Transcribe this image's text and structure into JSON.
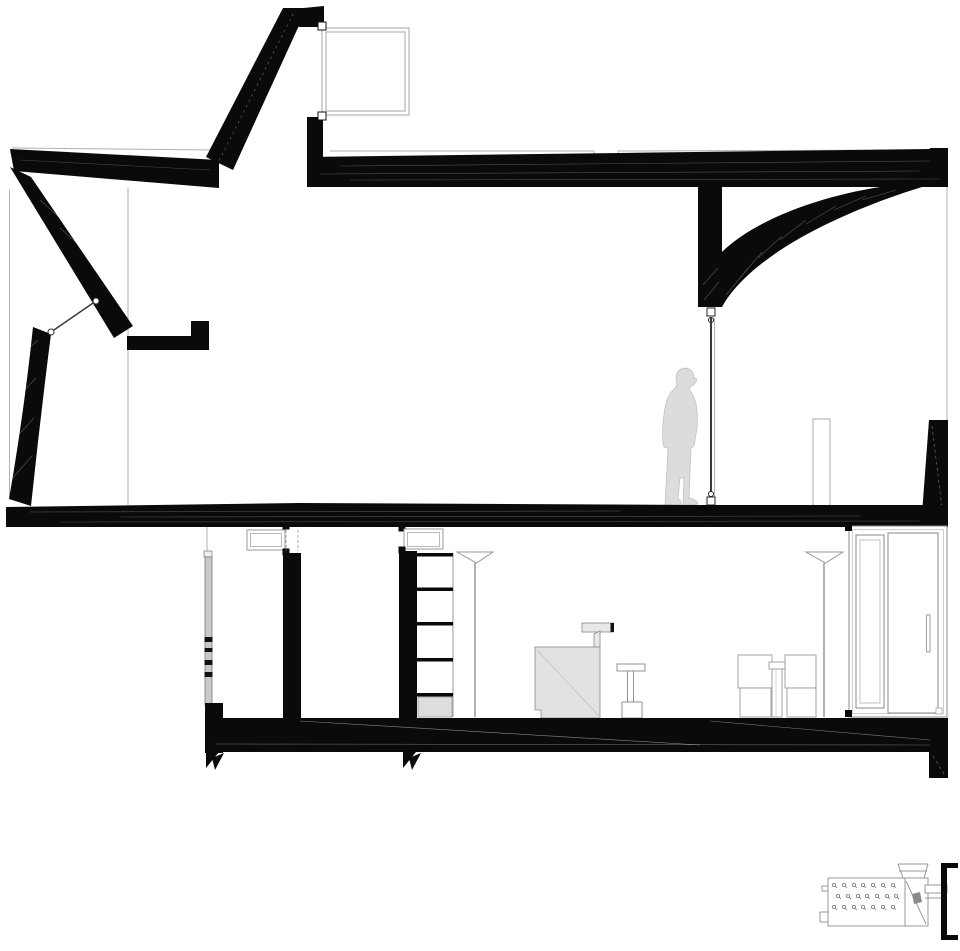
{
  "drawing": {
    "type": "architectural-longitudinal-section",
    "description": "Black-and-white architectural section drawing of a two-level interior with sloped roof, suspended column with curved haunch, tie rod, standing human figure, basement furniture and a small equipment detail at bottom right",
    "elements": [
      "chimney-cap",
      "skylight-window",
      "left-roof-slab",
      "right-roof-slab",
      "sloped-chimney-wall",
      "leaning-left-wall",
      "tie-cable",
      "ledge-bracket",
      "hanging-column",
      "curved-haunch",
      "tie-rod",
      "human-figure",
      "pilaster-outline",
      "right-wall-wedge",
      "main-floor-slab",
      "ceiling-cabinet-left",
      "ceiling-cabinet-right",
      "basement-wall-left",
      "basement-wall-right",
      "window-strip",
      "bookshelf",
      "floor-lamp-left",
      "floor-lamp-right",
      "desk-with-lamp",
      "stool",
      "storage-boxes",
      "wardrobe",
      "basement-floor-slab",
      "foundation-pier",
      "break-marks",
      "equipment-detail"
    ]
  },
  "palette": {
    "ink": "#0a0a0a",
    "hairline": "#b0b0b0",
    "outline": "#8f8f8f",
    "light_outline": "#aaaaaa",
    "figure_fill": "#dcdcdc",
    "figure_stroke": "#bdbdbd",
    "furniture_fill": "#e2e2e2",
    "shelf_fill": "#dddddd",
    "window_fill": "#c9c9c9",
    "background": "#ffffff"
  },
  "canvas": {
    "width": 960,
    "height": 951
  }
}
